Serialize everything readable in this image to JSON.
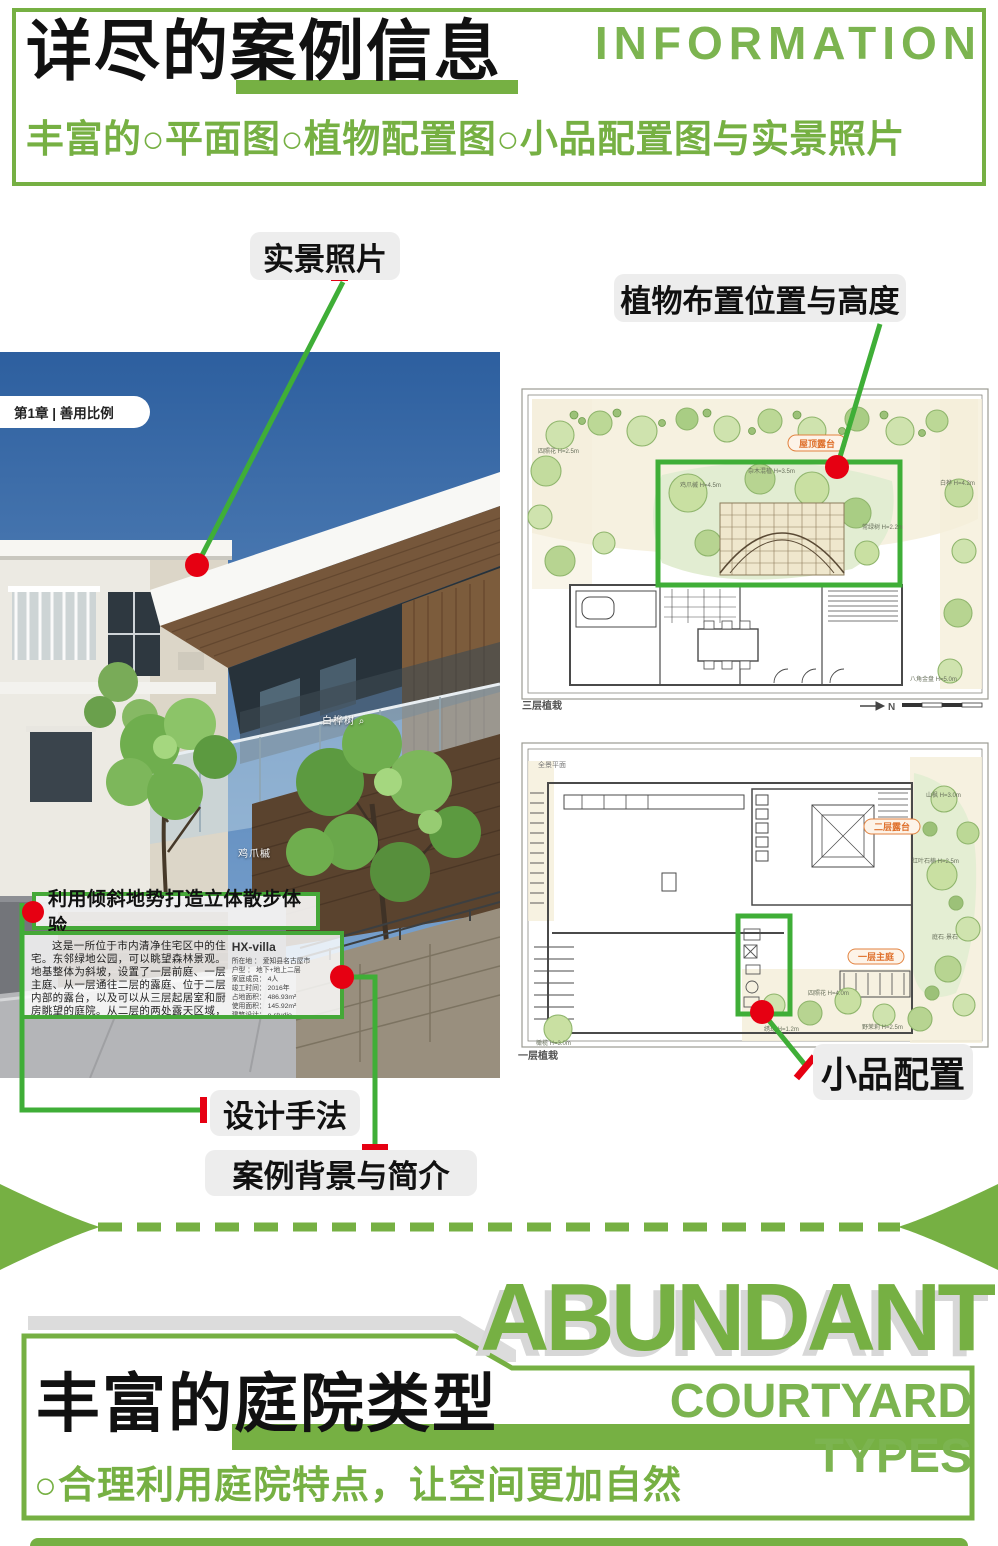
{
  "colors": {
    "green": "#76b043",
    "green_bright": "#3fae37",
    "green_text": "#7cb450",
    "red": "#e60012",
    "pill_bg": "#ededed",
    "shadow_gray": "#d7d7d7",
    "badge_orange": "#df702c"
  },
  "header": {
    "title_cn": "详尽的案例信息",
    "title_en": "INFORMATION",
    "subtitle": "丰富的○平面图○植物配置图○小品配置图与实景照片"
  },
  "callouts": {
    "photo": "实景照片",
    "plants": "植物布置位置与高度",
    "design": "设计手法",
    "background": "案例背景与简介",
    "ornament": "小品配置"
  },
  "photo": {
    "chapter_tag": "第1章 | 善用比例",
    "overlay_title": "利用倾斜地势打造立体散步体验",
    "overlay_text": "这是一所位于市内清净住宅区中的住宅。东邻绿地公园，可以眺望森林景观。地基整体为斜坡，设置了一层前庭、一层主庭、从一层通往二层的露庭、位于二层内部的露台，以及可以从三层起居室和厨房眺望的庭院。从二层的两处露天区域，均可观赏到公园的森林美景。",
    "project": {
      "name": "HX-villa",
      "specs": [
        "所在地 ： 爱知县名古屋市",
        "户型 ： 地下+地上二层",
        "家庭成员： 4人",
        "竣工时间： 2016年",
        "占地面积： 486.93m²",
        "使用面积： 145.92m²",
        "建筑设计： e-studio"
      ]
    },
    "plant_tags": {
      "tag1": "白桦树",
      "tag2": "鸡爪槭"
    }
  },
  "plans": {
    "north_label": "N",
    "top": {
      "caption": "三层植栽",
      "badge": "屋顶露台",
      "tree_labels": [
        "四照花 H=2.5m",
        "鸡爪槭 H=4.5m",
        "杂木混植 H=3.5m",
        "常绿树 H=2.2m",
        "白桦 H=4.2m",
        "八角金盘 H=5.0m"
      ]
    },
    "bottom": {
      "caption": "一层植栽",
      "note": "全景平面",
      "badge_upper": "二层露台",
      "badge_lower": "一层主庭",
      "tree_labels": [
        "山枫 H=3.0m",
        "红叶石楠 H=2.5m",
        "四照花 H=4.0m",
        "野茉莉 H=2.5m",
        "绣球 H=1.2m",
        "庭石·景石",
        "橄榄 H=3.0m"
      ]
    }
  },
  "section2": {
    "title_en_big": "ABUNDANT",
    "title_cn": "丰富的庭院类型",
    "title_en_small": "COURTYARD TYPES",
    "subtitle": "○合理利用庭院特点，让空间更加自然"
  }
}
